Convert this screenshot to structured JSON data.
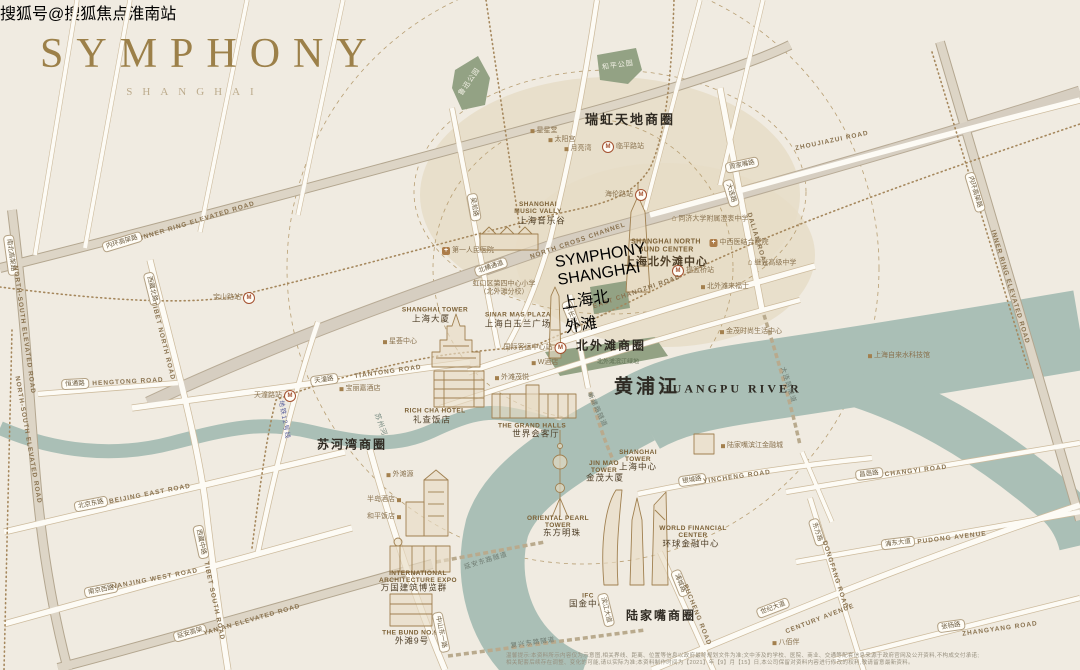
{
  "logo": {
    "title": "SYMPHONY",
    "subtitle": "SHANGHAI"
  },
  "watermark": "搜狐号@搜狐焦点淮南站",
  "project": {
    "ring_icon": "ring-logo",
    "name_en": "SYMPHONY SHANGHAI",
    "name_cn": "上海北外滩"
  },
  "colors": {
    "paper": "#f0ebe1",
    "river": "#aabfb6",
    "park": "#93a284",
    "highlight_tan": "#e6dcc5",
    "gold": "#a08050",
    "road_fill": "#fdfbf5",
    "road_casing": "#cdbb9d",
    "watermark_red": "#7b241e"
  },
  "rivers": {
    "main_cn": "黄浦江",
    "main_en": "HUANGPU RIVER",
    "creek_cn": "苏州河"
  },
  "business_districts": [
    "瑞虹天地商圈",
    "北外滩商圈",
    "苏河湾商圈",
    "陆家嘴商圈"
  ],
  "parks": [
    "鲁迅公园",
    "和平公园"
  ],
  "metro_stations": [
    "临平路站",
    "海伦路站",
    "宝山路站",
    "天潼路站",
    "国际客运中心站",
    "提篮桥站"
  ],
  "metro_line": "地铁12号线",
  "labels": [
    {
      "k": "district",
      "t": "瑞虹天地商圈",
      "x": 630,
      "y": 120,
      "s": 13,
      "n": "district-ruihong"
    },
    {
      "k": "district",
      "t": "北外滩商圈",
      "x": 611,
      "y": 346,
      "s": 12,
      "n": "district-north-bund"
    },
    {
      "k": "district",
      "t": "苏河湾商圈",
      "x": 352,
      "y": 445,
      "s": 12,
      "n": "district-suhewan"
    },
    {
      "k": "district",
      "t": "陆家嘴商圈",
      "x": 661,
      "y": 616,
      "s": 12,
      "n": "district-lujiazui"
    },
    {
      "k": "water",
      "t": "黄浦江",
      "x": 647,
      "y": 388,
      "s": 19,
      "n": "huangpu-river-cn"
    },
    {
      "k": "water",
      "t": "HUANGPU RIVER",
      "x": 731,
      "y": 389,
      "s": 12,
      "n": "huangpu-river-en"
    },
    {
      "k": "tunnel",
      "t": "苏州河",
      "x": 380,
      "y": 425,
      "r": 70,
      "s": 7,
      "c": "#75897f",
      "n": "suzhou-creek-label"
    },
    {
      "k": "park",
      "t": "鲁迅公园",
      "x": 470,
      "y": 82,
      "r": -55,
      "n": "park-luxun"
    },
    {
      "k": "park",
      "t": "和平公园",
      "x": 618,
      "y": 66,
      "r": -8,
      "n": "park-heping"
    },
    {
      "k": "lmen",
      "t": "SHANGHAI\nMUSIC VALLY",
      "x": 538,
      "y": 208
    },
    {
      "k": "lmcn",
      "t": "上海音乐谷",
      "x": 542,
      "y": 221
    },
    {
      "k": "lmen",
      "t": "SHANGHAI NORTH\nBUND CENTER",
      "x": 666,
      "y": 246,
      "s": 7
    },
    {
      "k": "lmcn",
      "t": "上海北外滩中心",
      "x": 666,
      "y": 262,
      "s": 11,
      "b": 1
    },
    {
      "k": "lmen",
      "t": "SINAR MAS PLAZA",
      "x": 518,
      "y": 315
    },
    {
      "k": "lmcn",
      "t": "上海白玉兰广场",
      "x": 518,
      "y": 324
    },
    {
      "k": "lmen",
      "t": "SHANGHAI TOWER",
      "x": 435,
      "y": 310
    },
    {
      "k": "lmcn",
      "t": "上海大厦",
      "x": 431,
      "y": 319
    },
    {
      "k": "lmen",
      "t": "RICH CHA HOTEL",
      "x": 435,
      "y": 411
    },
    {
      "k": "lmcn",
      "t": "礼查饭店",
      "x": 432,
      "y": 420
    },
    {
      "k": "lmen",
      "t": "THE GRAND HALLS",
      "x": 532,
      "y": 426
    },
    {
      "k": "lmcn",
      "t": "世界会客厅",
      "x": 536,
      "y": 434
    },
    {
      "k": "lmen",
      "t": "INTERNATIONAL\nARCHITECTURE EXPO",
      "x": 418,
      "y": 577
    },
    {
      "k": "lmcn",
      "t": "万国建筑博览群",
      "x": 414,
      "y": 588
    },
    {
      "k": "lmen",
      "t": "THE BUND NO.9",
      "x": 410,
      "y": 633
    },
    {
      "k": "lmcn",
      "t": "外滩9号",
      "x": 412,
      "y": 641
    },
    {
      "k": "lmen",
      "t": "ORIENTAL PEARL\nTOWER",
      "x": 558,
      "y": 522
    },
    {
      "k": "lmcn",
      "t": "东方明珠",
      "x": 562,
      "y": 533
    },
    {
      "k": "lmen",
      "t": "JIN MAO\nTOWER",
      "x": 604,
      "y": 467
    },
    {
      "k": "lmcn",
      "t": "金茂大厦",
      "x": 605,
      "y": 478
    },
    {
      "k": "lmen",
      "t": "SHANGHAI\nTOWER",
      "x": 638,
      "y": 456
    },
    {
      "k": "lmcn",
      "t": "上海中心",
      "x": 638,
      "y": 467
    },
    {
      "k": "lmen",
      "t": "WORLD FINANCIAL\nCENTER",
      "x": 693,
      "y": 532
    },
    {
      "k": "lmcn",
      "t": "环球金融中心",
      "x": 691,
      "y": 544
    },
    {
      "k": "lmen",
      "t": "IFC",
      "x": 588,
      "y": 596
    },
    {
      "k": "lmcn",
      "t": "国金中心",
      "x": 588,
      "y": 604
    },
    {
      "k": "poi",
      "t": "星星堂",
      "x": 544,
      "y": 131,
      "d": "l"
    },
    {
      "k": "poi",
      "t": "太阳宫",
      "x": 562,
      "y": 140,
      "d": "l"
    },
    {
      "k": "poi",
      "t": "月亮湾",
      "x": 578,
      "y": 149,
      "d": "l"
    },
    {
      "k": "poi",
      "t": "星荟中心",
      "x": 400,
      "y": 342,
      "d": "l"
    },
    {
      "k": "poi2",
      "t": "虹口区第四中心小学\n（北外滩分校）",
      "x": 504,
      "y": 288
    },
    {
      "k": "schl",
      "t": "同济大学附属澄衷中学",
      "x": 710,
      "y": 219
    },
    {
      "k": "hosp",
      "t": "中西医结合医院",
      "x": 739,
      "y": 243
    },
    {
      "k": "schl",
      "t": "继光高级中学",
      "x": 772,
      "y": 263
    },
    {
      "k": "poi",
      "t": "北外滩来福士",
      "x": 725,
      "y": 287,
      "d": "l"
    },
    {
      "k": "poi",
      "t": "金茂时尚生活中心",
      "x": 751,
      "y": 332,
      "d": "l"
    },
    {
      "k": "poi",
      "t": "上海自来水科技馆",
      "x": 899,
      "y": 356,
      "d": "l"
    },
    {
      "k": "poi",
      "t": "W酒店",
      "x": 545,
      "y": 363,
      "d": "l"
    },
    {
      "k": "poi",
      "t": "外滩茂悦",
      "x": 512,
      "y": 378,
      "d": "l"
    },
    {
      "k": "poi",
      "t": "宝丽嘉酒店",
      "x": 360,
      "y": 389,
      "d": "l"
    },
    {
      "k": "poi",
      "t": "外滩源",
      "x": 400,
      "y": 475,
      "d": "l"
    },
    {
      "k": "poi",
      "t": "半岛酒店",
      "x": 384,
      "y": 500,
      "d": "r"
    },
    {
      "k": "poi",
      "t": "和平饭店",
      "x": 384,
      "y": 517,
      "d": "r"
    },
    {
      "k": "poi",
      "t": "陆家嘴滨江金融城",
      "x": 752,
      "y": 446,
      "d": "l"
    },
    {
      "k": "poi",
      "t": "八佰伴",
      "x": 786,
      "y": 643,
      "d": "l"
    },
    {
      "k": "poi",
      "t": "北外滩滨江绿地",
      "x": 618,
      "y": 363,
      "s": 6,
      "c": "#5f6f52"
    },
    {
      "k": "hosp",
      "t": "第一人民医院",
      "x": 468,
      "y": 251
    },
    {
      "k": "metro",
      "t": "临平路站",
      "x": 623,
      "y": 147,
      "d": "r",
      "n": "metro-linpinglu"
    },
    {
      "k": "metro",
      "t": "海伦路站",
      "x": 626,
      "y": 195,
      "d": "l",
      "n": "metro-hailunlu"
    },
    {
      "k": "metro",
      "t": "宝山路站",
      "x": 234,
      "y": 298,
      "d": "l",
      "n": "metro-baoshanlu"
    },
    {
      "k": "metro",
      "t": "天潼路站",
      "x": 275,
      "y": 396,
      "d": "l",
      "n": "metro-tiantonglu"
    },
    {
      "k": "metro",
      "t": "国际客运中心站",
      "x": 535,
      "y": 348,
      "d": "l",
      "n": "metro-intl-cruise-terminal"
    },
    {
      "k": "metro",
      "t": "提篮桥站",
      "x": 693,
      "y": 271,
      "d": "r",
      "n": "metro-tilanqiao"
    },
    {
      "k": "mline",
      "t": "地铁12号线",
      "x": 284,
      "y": 420,
      "r": 80,
      "c": "#5c619c",
      "n": "metro-line12-label"
    },
    {
      "k": "road",
      "t": "内环高架路",
      "x": 122,
      "y": 242,
      "r": -17
    },
    {
      "k": "roaden",
      "t": "INNER RING ELEVATED ROAD",
      "x": 198,
      "y": 221,
      "r": -17
    },
    {
      "k": "road",
      "t": "内环高架路",
      "x": 975,
      "y": 192,
      "r": 73
    },
    {
      "k": "roaden",
      "t": "INNER RING ELEVATED ROAD",
      "x": 1010,
      "y": 287,
      "r": 73
    },
    {
      "k": "road",
      "t": "北横通道",
      "x": 491,
      "y": 267,
      "r": -19
    },
    {
      "k": "roaden",
      "t": "NORTH CROSS CHANNEL",
      "x": 578,
      "y": 241,
      "r": -19
    },
    {
      "k": "road",
      "t": "周家嘴路",
      "x": 742,
      "y": 165,
      "r": -12
    },
    {
      "k": "roaden",
      "t": "ZHOUJIAZUI ROAD",
      "x": 832,
      "y": 141,
      "r": -12
    },
    {
      "k": "road",
      "t": "东长治路",
      "x": 572,
      "y": 317,
      "r": 68
    },
    {
      "k": "roaden",
      "t": "EAST CHANGZHI ROAD",
      "x": 637,
      "y": 292,
      "r": -19
    },
    {
      "k": "road",
      "t": "大连路",
      "x": 731,
      "y": 193,
      "r": 73
    },
    {
      "k": "roaden",
      "t": "DALIAN ROAD",
      "x": 757,
      "y": 240,
      "r": 73
    },
    {
      "k": "road",
      "t": "天潼路",
      "x": 324,
      "y": 380,
      "r": -8
    },
    {
      "k": "roaden",
      "t": "TIANTONG ROAD",
      "x": 388,
      "y": 372,
      "r": -8
    },
    {
      "k": "road",
      "t": "恒通路",
      "x": 75,
      "y": 384,
      "r": -3
    },
    {
      "k": "roaden",
      "t": "HENGTONG ROAD",
      "x": 128,
      "y": 382,
      "r": -3
    },
    {
      "k": "road",
      "t": "西藏北路",
      "x": 152,
      "y": 289,
      "r": 76
    },
    {
      "k": "roaden",
      "t": "TIBET NORTH ROAD",
      "x": 163,
      "y": 341,
      "r": 76
    },
    {
      "k": "road",
      "t": "南北高架路",
      "x": 11,
      "y": 255,
      "r": 82
    },
    {
      "k": "roaden",
      "t": "NORTH-SOUTH ELEVATED ROAD",
      "x": 24,
      "y": 330,
      "r": 82
    },
    {
      "k": "roaden",
      "t": "NORTH-SOUTH ELEVATED ROAD",
      "x": 28,
      "y": 440,
      "r": 80
    },
    {
      "k": "road",
      "t": "北京东路",
      "x": 91,
      "y": 504,
      "r": -11
    },
    {
      "k": "roaden",
      "t": "BEIJING EAST ROAD",
      "x": 150,
      "y": 494,
      "r": -11
    },
    {
      "k": "road",
      "t": "南京西路",
      "x": 101,
      "y": 590,
      "r": -11
    },
    {
      "k": "roaden",
      "t": "NANJING WEST ROAD",
      "x": 155,
      "y": 579,
      "r": -11
    },
    {
      "k": "road",
      "t": "西藏中路",
      "x": 201,
      "y": 542,
      "r": 78
    },
    {
      "k": "roaden",
      "t": "TIBET SOUTH ROAD",
      "x": 214,
      "y": 601,
      "r": 78
    },
    {
      "k": "road",
      "t": "延安高架",
      "x": 190,
      "y": 633,
      "r": -16
    },
    {
      "k": "roaden",
      "t": "YAN'AN ELEVATED ROAD",
      "x": 252,
      "y": 620,
      "r": -16
    },
    {
      "k": "road",
      "t": "中山东一路",
      "x": 441,
      "y": 632,
      "r": 78
    },
    {
      "k": "road",
      "t": "吴淞路",
      "x": 474,
      "y": 207,
      "r": 80
    },
    {
      "k": "road",
      "t": "银城路",
      "x": 692,
      "y": 480,
      "r": -8
    },
    {
      "k": "roaden",
      "t": "YINCHENG ROAD",
      "x": 737,
      "y": 477,
      "r": -8
    },
    {
      "k": "road",
      "t": "昌邑路",
      "x": 869,
      "y": 474,
      "r": -7
    },
    {
      "k": "roaden",
      "t": "CHANGYI ROAD",
      "x": 916,
      "y": 471,
      "r": -7
    },
    {
      "k": "road",
      "t": "浦东大道",
      "x": 898,
      "y": 543,
      "r": -7
    },
    {
      "k": "roaden",
      "t": "PUDONG AVENUE",
      "x": 952,
      "y": 538,
      "r": -7
    },
    {
      "k": "road",
      "t": "张杨路",
      "x": 951,
      "y": 626,
      "r": -8
    },
    {
      "k": "roaden",
      "t": "ZHANGYANG ROAD",
      "x": 1000,
      "y": 629,
      "r": -8
    },
    {
      "k": "road",
      "t": "世纪大道",
      "x": 773,
      "y": 608,
      "r": -21
    },
    {
      "k": "roaden",
      "t": "CENTURY AVENUE",
      "x": 820,
      "y": 619,
      "r": -21
    },
    {
      "k": "road",
      "t": "东方路",
      "x": 817,
      "y": 532,
      "r": 72
    },
    {
      "k": "roaden",
      "t": "DONGFANG ROAD",
      "x": 835,
      "y": 575,
      "r": 72
    },
    {
      "k": "road",
      "t": "浦城路",
      "x": 680,
      "y": 583,
      "r": 68
    },
    {
      "k": "roaden",
      "t": "PUCHENG ROAD",
      "x": 697,
      "y": 615,
      "r": 68
    },
    {
      "k": "road",
      "t": "滨江大道",
      "x": 606,
      "y": 610,
      "r": 76
    },
    {
      "k": "tunnel",
      "t": "大连路隧道",
      "x": 788,
      "y": 385,
      "r": 72
    },
    {
      "k": "tunnel",
      "t": "新建路隧道",
      "x": 597,
      "y": 410,
      "r": 65
    },
    {
      "k": "tunnel",
      "t": "延安东路隧道",
      "x": 486,
      "y": 561,
      "r": -17
    },
    {
      "k": "tunnel",
      "t": "复兴东路隧道",
      "x": 533,
      "y": 643,
      "r": -8
    },
    {
      "k": "note",
      "t": "温馨提示:本资料所示内容仅为示意图,相关界线、距离、位置等信息以政府最终规划文件为准;文中涉及的学校、医院、商业、交通等配套信息来源于政府官网及公开资料,不构成交付承诺;",
      "x": 506,
      "y": 656,
      "a": "l",
      "n": "map-disclaimer-line1"
    },
    {
      "k": "note",
      "t": "相关配套后续存在调整、变化的可能,请以实际为准;本资料制作时间为【2021】年【9】月【15】日,本公司保留对资料内容进行修改的权利,敬请留意最新资料。",
      "x": 506,
      "y": 663,
      "a": "l",
      "n": "map-disclaimer-line2"
    }
  ]
}
